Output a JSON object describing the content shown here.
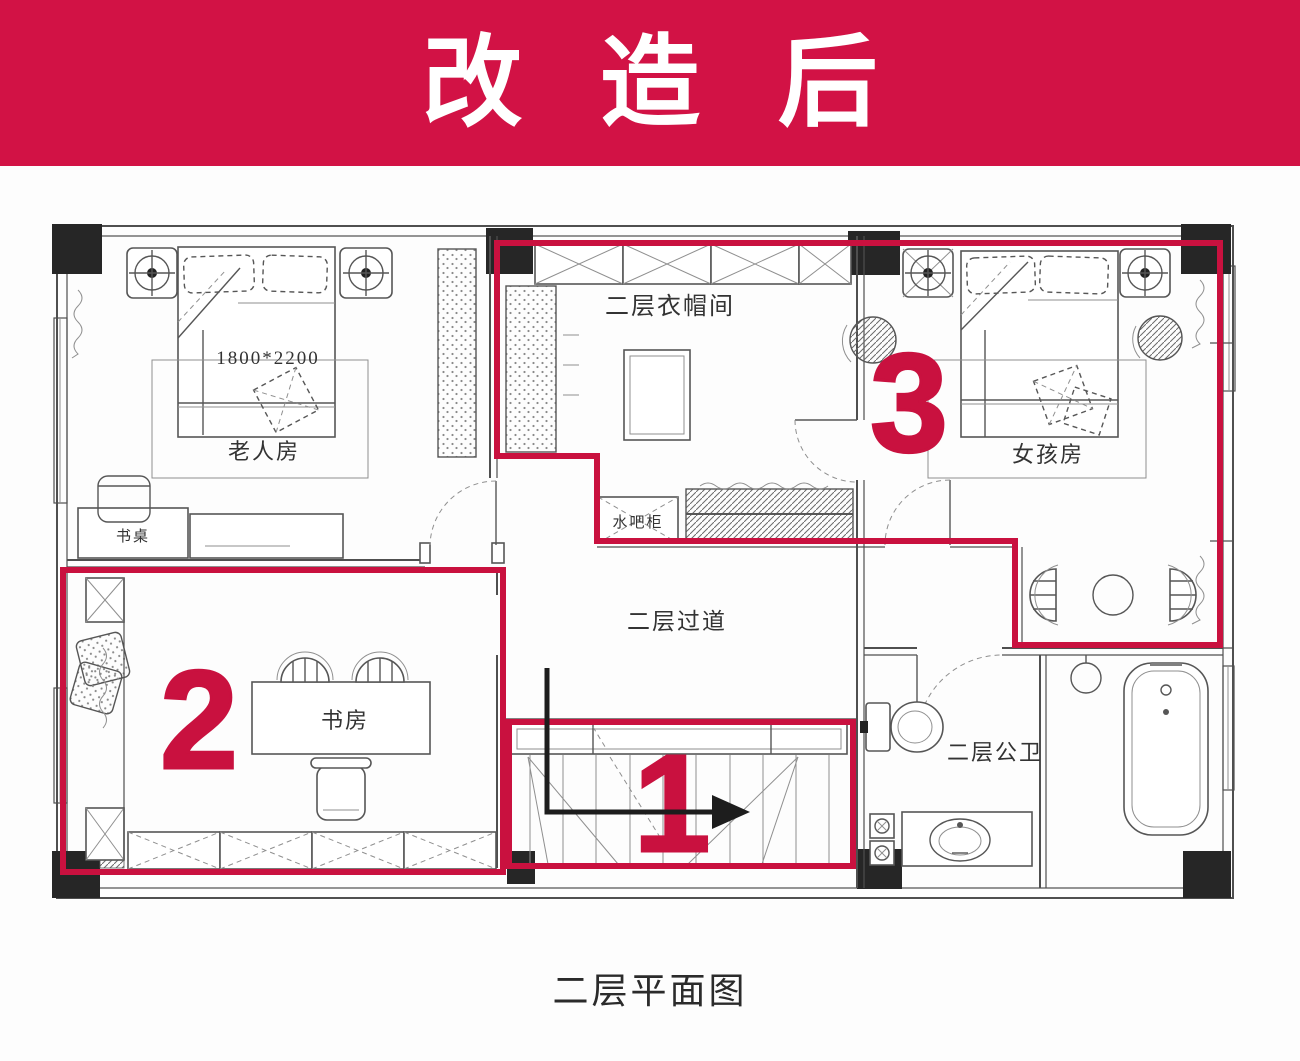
{
  "banner": {
    "title": "改 造 后"
  },
  "plan": {
    "labels": {
      "elder_room": "老人房",
      "bed_size": "1800*2200",
      "desk": "书桌",
      "cloakroom": "二层衣帽间",
      "water_bar": "水吧柜",
      "girl_room": "女孩房",
      "corridor": "二层过道",
      "study": "书房",
      "bathroom": "二层公卫"
    },
    "markers": {
      "stairs": "1",
      "study": "2",
      "bedroom_suite": "3"
    },
    "caption": "二层平面图",
    "colors": {
      "banner": "#D21245",
      "accent": "#C9113F",
      "wall": "#4f4f4f",
      "column": "#262626",
      "ink": "#333333"
    }
  }
}
